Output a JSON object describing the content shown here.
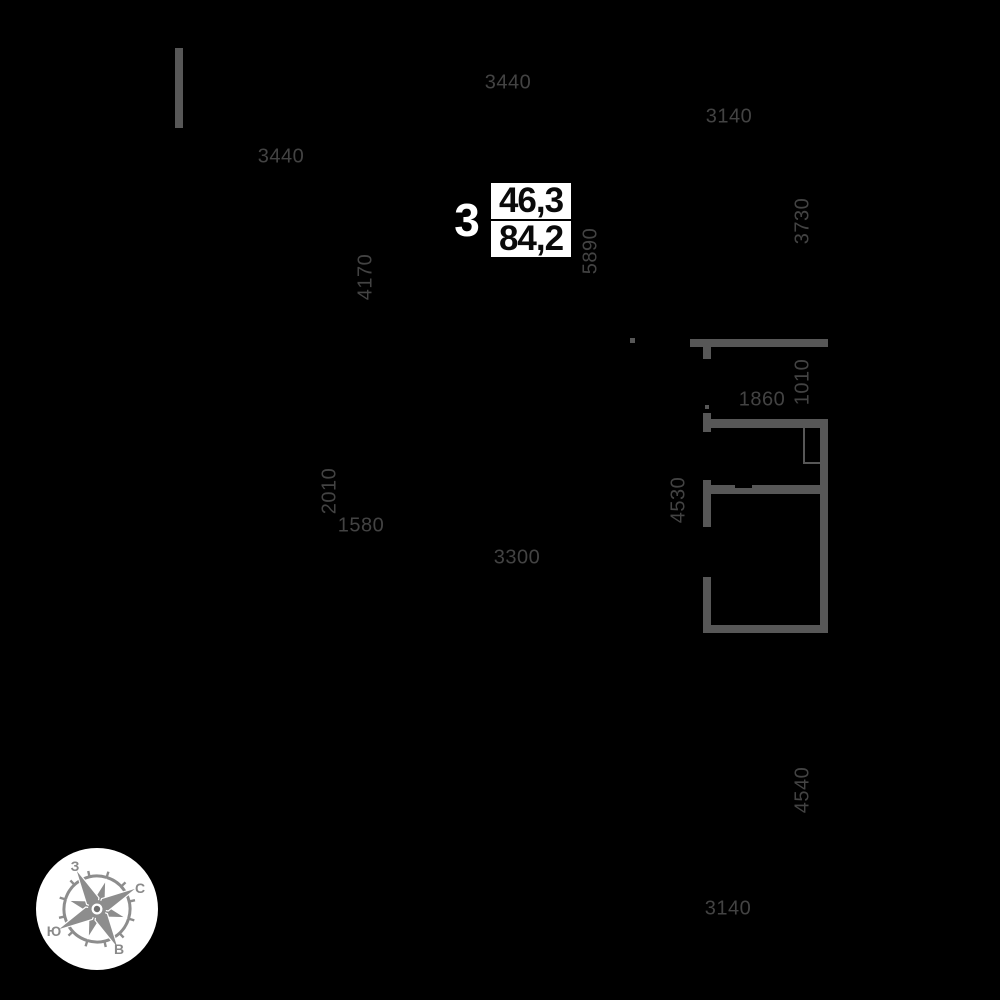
{
  "plan": {
    "background": "#000000",
    "wall_color": "#575757",
    "dim_color": "#434343",
    "dimensions": [
      {
        "text": "3440",
        "x": 508,
        "y": 83,
        "rotated": false
      },
      {
        "text": "3140",
        "x": 729,
        "y": 117,
        "rotated": false
      },
      {
        "text": "3440",
        "x": 281,
        "y": 157,
        "rotated": false
      },
      {
        "text": "3730",
        "x": 803,
        "y": 221,
        "rotated": true
      },
      {
        "text": "4170",
        "x": 366,
        "y": 277,
        "rotated": true
      },
      {
        "text": "5890",
        "x": 591,
        "y": 251,
        "rotated": true
      },
      {
        "text": "1010",
        "x": 803,
        "y": 382,
        "rotated": true
      },
      {
        "text": "1860",
        "x": 762,
        "y": 400,
        "rotated": false
      },
      {
        "text": "2010",
        "x": 330,
        "y": 491,
        "rotated": true
      },
      {
        "text": "1580",
        "x": 361,
        "y": 526,
        "rotated": false
      },
      {
        "text": "3300",
        "x": 517,
        "y": 558,
        "rotated": false
      },
      {
        "text": "4530",
        "x": 679,
        "y": 500,
        "rotated": true
      },
      {
        "text": "4540",
        "x": 803,
        "y": 790,
        "rotated": true
      },
      {
        "text": "3140",
        "x": 728,
        "y": 909,
        "rotated": false
      }
    ],
    "walls": [
      {
        "name": "wall-top-left-bar",
        "x": 175,
        "y": 48,
        "w": 8,
        "h": 80
      },
      {
        "name": "wall-tick-mark",
        "x": 630,
        "y": 338,
        "w": 5,
        "h": 5
      },
      {
        "name": "wall-upper-horizontal",
        "x": 690,
        "y": 339,
        "w": 138,
        "h": 8
      },
      {
        "name": "wall-door-jamb-top",
        "x": 703,
        "y": 347,
        "w": 8,
        "h": 12
      },
      {
        "name": "wall-door-jamb-tick",
        "x": 705,
        "y": 405,
        "w": 4,
        "h": 4
      },
      {
        "name": "wall-door-jamb-bottom",
        "x": 703,
        "y": 413,
        "w": 8,
        "h": 6
      },
      {
        "name": "wall-mid-horizontal",
        "x": 703,
        "y": 419,
        "w": 125,
        "h": 9
      },
      {
        "name": "wall-left-stub",
        "x": 703,
        "y": 428,
        "w": 8,
        "h": 4
      },
      {
        "name": "wall-right-vertical",
        "x": 820,
        "y": 419,
        "w": 8,
        "h": 214
      },
      {
        "name": "wall-niche-left-line",
        "x": 803,
        "y": 428,
        "w": 2,
        "h": 36
      },
      {
        "name": "wall-niche-bottom-line",
        "x": 803,
        "y": 462,
        "w": 17,
        "h": 2
      },
      {
        "name": "wall-left-segment-1",
        "x": 703,
        "y": 480,
        "w": 8,
        "h": 47
      },
      {
        "name": "wall-inner-horizontal",
        "x": 703,
        "y": 485,
        "w": 117,
        "h": 9
      },
      {
        "name": "wall-opening-notch",
        "x": 735,
        "y": 485,
        "w": 17,
        "h": 3,
        "color": "#000000"
      },
      {
        "name": "wall-left-segment-2",
        "x": 703,
        "y": 577,
        "w": 8,
        "h": 56
      },
      {
        "name": "wall-bottom-horizontal",
        "x": 703,
        "y": 625,
        "w": 125,
        "h": 8
      }
    ]
  },
  "apartment": {
    "number": "3",
    "living_area": "46,3",
    "total_area": "84,2"
  },
  "compass": {
    "north": "С",
    "south": "Ю",
    "west": "З",
    "east": "В",
    "circle_color": "#ffffff",
    "rose_color": "#8d8d8d"
  }
}
